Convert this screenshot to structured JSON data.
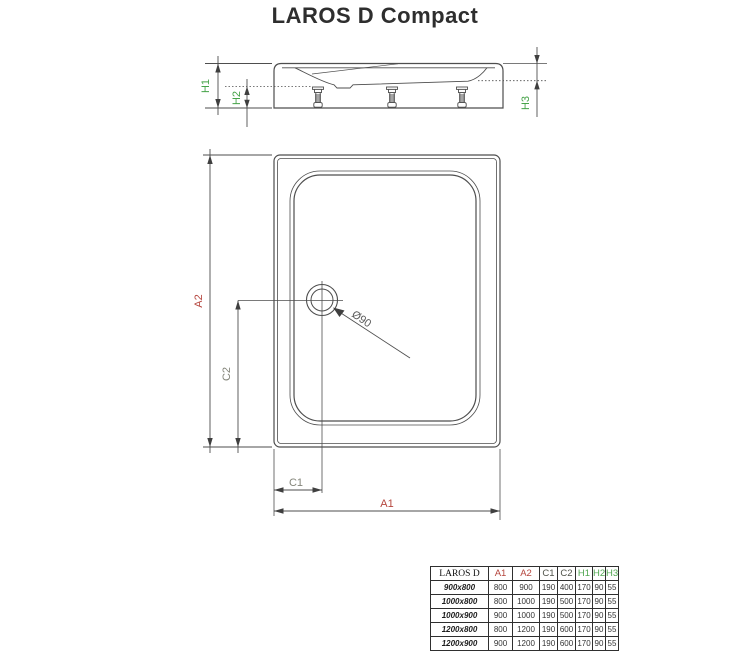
{
  "title": "LAROS D Compact",
  "drawing": {
    "side": {
      "h1": "H1",
      "h2": "H2",
      "h3": "H3"
    },
    "plan": {
      "a1": "A1",
      "a2": "A2",
      "c1": "C1",
      "c2": "C2",
      "drain_diameter": "Ø90"
    }
  },
  "colors": {
    "dimension_red": "#b5463e",
    "dimension_green": "#46a349",
    "dimension_gray": "#84857a",
    "line": "#4e4e4e"
  },
  "table": {
    "product_header": "LAROS D",
    "columns": [
      "A1",
      "A2",
      "C1",
      "C2",
      "H1",
      "H2",
      "H3"
    ],
    "rows": [
      {
        "size": "900x800",
        "values": [
          "800",
          "900",
          "190",
          "400",
          "170",
          "90",
          "55"
        ]
      },
      {
        "size": "1000x800",
        "values": [
          "800",
          "1000",
          "190",
          "500",
          "170",
          "90",
          "55"
        ]
      },
      {
        "size": "1000x900",
        "values": [
          "900",
          "1000",
          "190",
          "500",
          "170",
          "90",
          "55"
        ]
      },
      {
        "size": "1200x800",
        "values": [
          "800",
          "1200",
          "190",
          "600",
          "170",
          "90",
          "55"
        ]
      },
      {
        "size": "1200x900",
        "values": [
          "900",
          "1200",
          "190",
          "600",
          "170",
          "90",
          "55"
        ]
      }
    ]
  }
}
